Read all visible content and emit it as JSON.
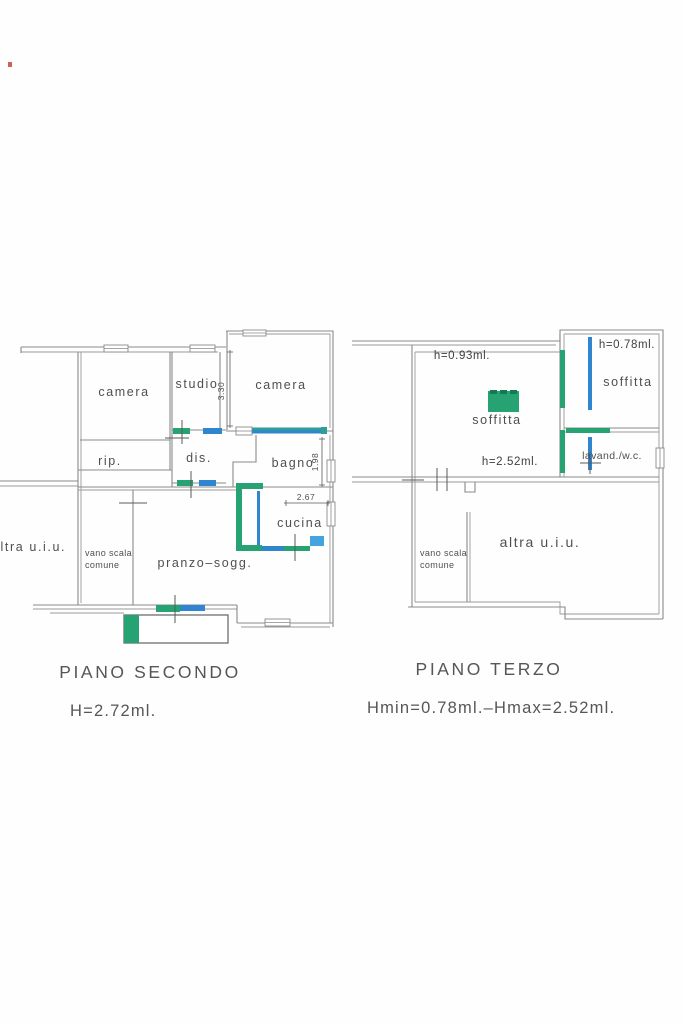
{
  "colors": {
    "wall_gray": "#8a8a8a",
    "text_gray": "#4f4f4f",
    "marker_green": "#27a273",
    "marker_green_dark": "#147a50",
    "marker_teal": "#2f9e99",
    "marker_blue": "#2f86cf",
    "marker_light_blue": "#44a4de",
    "artifact_red": "#c0392b"
  },
  "plan_secondo": {
    "caption": "PIANO  SECONDO",
    "height_note": "H=2.72ml.",
    "rooms": {
      "camera1": "camera",
      "studio": "studio",
      "camera2": "camera",
      "rip": "rip.",
      "dis": "dis.",
      "bagno": "bagno",
      "cucina": "cucina",
      "pranzo": "pranzo–sogg.",
      "vano_scala_line1": "vano scala",
      "vano_scala_line2": "comune",
      "altra": "altra  u.i.u."
    },
    "dimensions": {
      "studio_depth": "3.30",
      "bagno_depth": "1.98",
      "cucina_width": "2.67"
    }
  },
  "plan_terzo": {
    "caption": "PIANO  TERZO",
    "height_note": "Hmin=0.78ml.–Hmax=2.52ml.",
    "rooms": {
      "soffitta_main": "soffitta",
      "soffitta_right": "soffitta",
      "lavand": "lavand./w.c.",
      "vano_scala_line1": "vano scala",
      "vano_scala_line2": "comune",
      "altra": "altra  u.i.u."
    },
    "height_labels": {
      "main_top": "h=0.93ml.",
      "right": "h=0.78ml.",
      "main_bottom": "h=2.52ml."
    }
  }
}
